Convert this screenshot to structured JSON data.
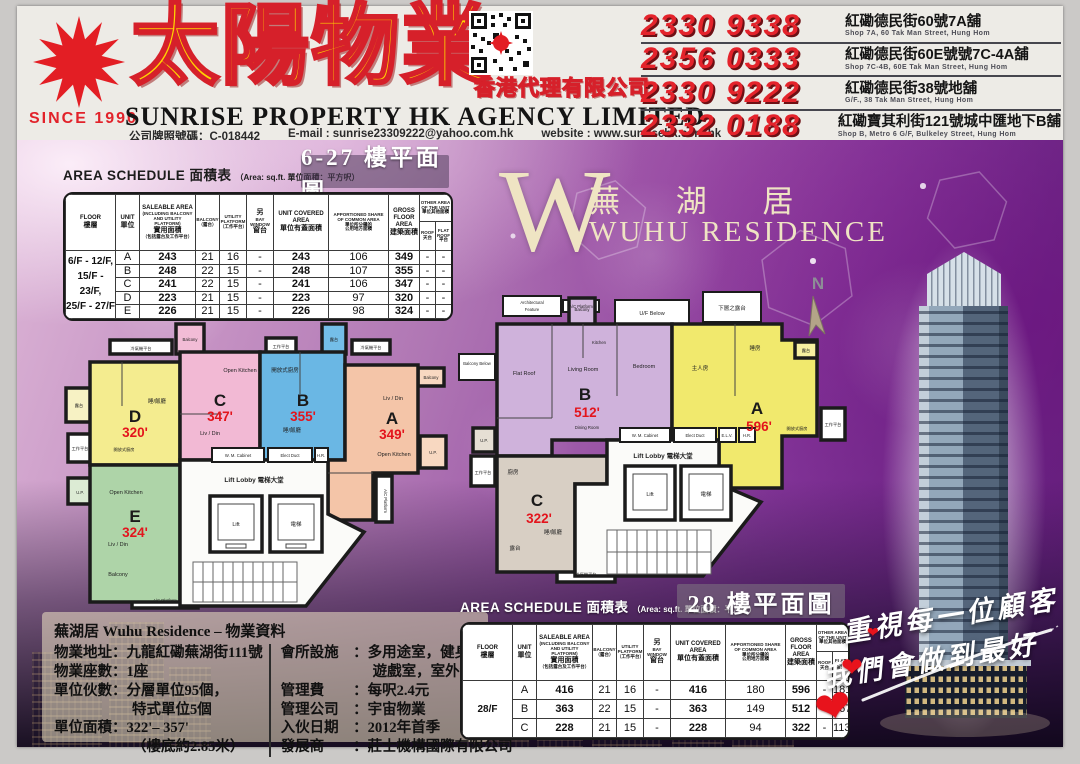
{
  "header": {
    "since": "SINCE 1990",
    "brand_cn": "太陽物業",
    "agency_cn": "香港代理有限公司",
    "brand_en": "SUNRISE PROPERTY HK AGENCY LIMITED",
    "license": "公司牌照號碼：C-018442",
    "email": "E-mail : sunrise23309222@yahoo.com.hk",
    "website": "website : www.sunrisehk.com.hk",
    "branches": [
      {
        "phone": "2330 9338",
        "address_cn": "紅磡德民街60號7A舖",
        "address_en": "Shop 7A, 60 Tak Man Street, Hung Hom"
      },
      {
        "phone": "2356 0333",
        "address_cn": "紅磡德民街60E號號7C-4A舖",
        "address_en": "Shop 7C-4B, 60E Tak Man Street, Hung Hom"
      },
      {
        "phone": "2330 9222",
        "address_cn": "紅磡德民街38號地舖",
        "address_en": "G/F., 38 Tak Man Street, Hung Hom"
      },
      {
        "phone": "2332 0188",
        "address_cn": "紅磡寶其利街121號城中匯地下B舖",
        "address_en": "Shop B, Metro 6 G/F, Bulkeley Street, Hung Hom"
      }
    ]
  },
  "project": {
    "logo_letter": "W",
    "name_cn": "蕪 湖 居",
    "name_en": "WUHU RESIDENCE"
  },
  "cols": {
    "floor_en": "FLOOR",
    "floor_cn": "樓層",
    "unit_en": "UNIT",
    "unit_cn": "單位",
    "sal_en": "SALEABLE AREA",
    "sal_sub": "(INCLUDING BALCONY AND UTILITY PLATFORM)",
    "sal_cn": "實用面積",
    "sal_cn_sub": "（包括露台及工作平台）",
    "bal_en": "BALCONY",
    "bal_cn": "（露台）",
    "ut_en": "UTILITY PLATFORM",
    "ut_cn": "（工作平台）",
    "bay_top": "另",
    "bay_en": "BAY WINDOW",
    "bay_cn": "窗台",
    "cov_en": "UNIT COVERED AREA",
    "cov_cn": "單位有蓋面積",
    "app_en1": "APPORTIONED SHARE",
    "app_en2": "OF COMMON AREA",
    "app_cn1": "單位所分攤的",
    "app_cn2": "公用地方面積",
    "gross_en": "GROSS FLOOR AREA",
    "gross_cn": "建築面積",
    "other_en": "OTHER AREA OF THE UNIT",
    "other_cn": "單位其他面積",
    "roof_en": "ROOF",
    "roof_cn": "天台",
    "flat_en": "FLAT ROOF",
    "flat_cn": "平台"
  },
  "s627": {
    "title": "AREA SCHEDULE 面積表",
    "note": "（Area: sq.ft. 單位面積：平方呎）",
    "plan_title": "6-27 樓平面圖",
    "floor1": "6/F - 12/F,",
    "floor2": "15/F - 23/F,",
    "floor3": "25/F - 27/F",
    "rows": [
      {
        "unit": "A",
        "saleable": "243",
        "balcony": "21",
        "utility": "16",
        "bay": "-",
        "covered": "243",
        "common": "106",
        "gross": "349",
        "roof": "-",
        "flat": "-"
      },
      {
        "unit": "B",
        "saleable": "248",
        "balcony": "22",
        "utility": "15",
        "bay": "-",
        "covered": "248",
        "common": "107",
        "gross": "355",
        "roof": "-",
        "flat": "-"
      },
      {
        "unit": "C",
        "saleable": "241",
        "balcony": "22",
        "utility": "15",
        "bay": "-",
        "covered": "241",
        "common": "106",
        "gross": "347",
        "roof": "-",
        "flat": "-"
      },
      {
        "unit": "D",
        "saleable": "223",
        "balcony": "21",
        "utility": "15",
        "bay": "-",
        "covered": "223",
        "common": "97",
        "gross": "320",
        "roof": "-",
        "flat": "-"
      },
      {
        "unit": "E",
        "saleable": "226",
        "balcony": "21",
        "utility": "15",
        "bay": "-",
        "covered": "226",
        "common": "98",
        "gross": "324",
        "roof": "-",
        "flat": "-"
      }
    ]
  },
  "s28": {
    "title": "AREA SCHEDULE 面積表",
    "note": "（Area: sq.ft. 單位面積：平方呎）",
    "plan_title": "28 樓平面圖",
    "floor": "28/F",
    "rows": [
      {
        "unit": "A",
        "saleable": "416",
        "balcony": "21",
        "utility": "16",
        "bay": "-",
        "covered": "416",
        "common": "180",
        "gross": "596",
        "roof": "-",
        "flat": "181"
      },
      {
        "unit": "B",
        "saleable": "363",
        "balcony": "22",
        "utility": "15",
        "bay": "-",
        "covered": "363",
        "common": "149",
        "gross": "512",
        "roof": "-",
        "flat": "167"
      },
      {
        "unit": "C",
        "saleable": "228",
        "balcony": "21",
        "utility": "15",
        "bay": "-",
        "covered": "228",
        "common": "94",
        "gross": "322",
        "roof": "-",
        "flat": "113"
      }
    ]
  },
  "plan627": {
    "units": {
      "a": {
        "letter": "A",
        "area": "349'"
      },
      "b": {
        "letter": "B",
        "area": "355'"
      },
      "c": {
        "letter": "C",
        "area": "347'"
      },
      "d": {
        "letter": "D",
        "area": "320'"
      },
      "e": {
        "letter": "E",
        "area": "324'"
      }
    }
  },
  "plan28": {
    "units": {
      "a": {
        "letter": "A",
        "area": "596'"
      },
      "b": {
        "letter": "B",
        "area": "512'"
      },
      "c": {
        "letter": "C",
        "area": "322'"
      }
    }
  },
  "labels": {
    "balcony": "Balcony",
    "balcony_cn": "露台",
    "up": "U.P.",
    "work_platform_cn": "工作平台",
    "open_kitchen": "Open Kitchen",
    "open_kitchen_cn": "開放式廚房",
    "livdin": "Liv / Din",
    "bed_din_cn": "睡/飯廳",
    "ac_platform": "A/C Platform",
    "ac_platform_cn": "冷氣機平台",
    "lift_lobby": "Lift Lobby 電梯大堂",
    "lift": "Lift",
    "lift_cn": "電梯",
    "wm_cabinet": "W. M. Cabinet",
    "elect_duct": "Elect Duct",
    "hr": "H.R.",
    "elv": "E.L.V.",
    "uf_below": "U/F Below",
    "lower_balcony_cn": "下層之露台",
    "balcony_below": "Balcony Below",
    "arch_feature1": "Architectural",
    "arch_feature2": "Feature",
    "flat_roof": "Flat Roof",
    "living_room": "Living Room",
    "dining_room": "Dining Room",
    "kitchen": "Kitchen",
    "bedroom": "Bedroom",
    "master_cn": "主人房",
    "bedroom_cn": "睡房",
    "kitchen_cn": "廚房",
    "north": "N"
  },
  "info": {
    "title": "蕪湖居  Wuhu Residence – 物業資料",
    "addr_l": "物業地址：",
    "addr_v": "九龍紅磡蕪湖街111號",
    "blocks_l": "物業座數：",
    "blocks_v": "1座",
    "units_l": "單位伙數：",
    "units_v": "分層單位95個，",
    "units_v2": "特式單位5個",
    "size_l": "單位面積：",
    "size_v": "322'– 357'",
    "size_v2": "（樓底約2.85米）",
    "club_l": "會所設施　：",
    "club_v": "多用途室，健身室，",
    "club_v2": "遊戲室，室外泳池",
    "fee_l": "管理費　　：",
    "fee_v": "每呎2.4元",
    "mgr_l": "管理公司　：",
    "mgr_v": "宇宙物業",
    "movein_l": "入伙日期　：",
    "movein_v": "2012年首季",
    "dev_l": "發展商　　：",
    "dev_v": "莊士機構國際有限公司"
  },
  "slogan": {
    "line1": "重視每一位顧客",
    "line2": "我們會做到最好"
  },
  "colors": {
    "brand_yellow": "#ffd300",
    "brand_red": "#d6202a",
    "phone_red": "#e4232b",
    "purple_deep": "#5d2277",
    "area_red": "#e3141c",
    "logo_cream": "#efe4c3"
  }
}
